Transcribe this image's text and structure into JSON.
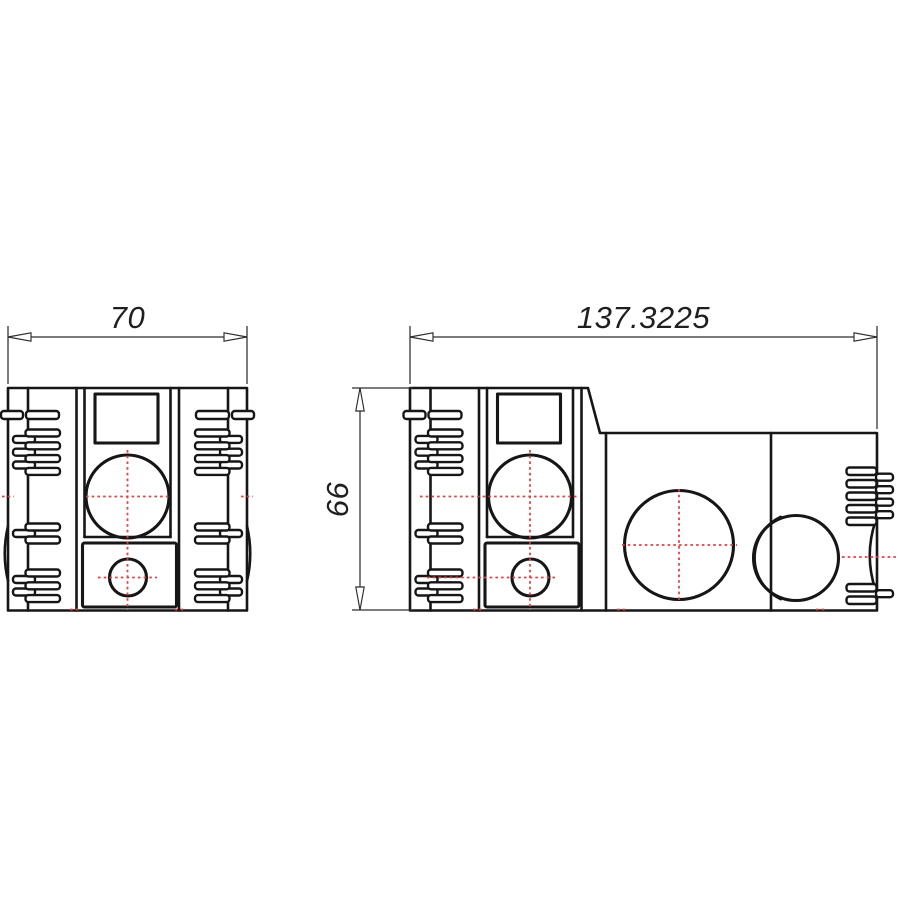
{
  "colors": {
    "paper": "#ffffff",
    "outline": "#161616",
    "dimension": "#2d2d2d",
    "dim_text": "#1f1f1f",
    "centerline": "#e24141"
  },
  "dimensions": {
    "front_width": "70",
    "side_width": "137.3225",
    "height": "66"
  }
}
